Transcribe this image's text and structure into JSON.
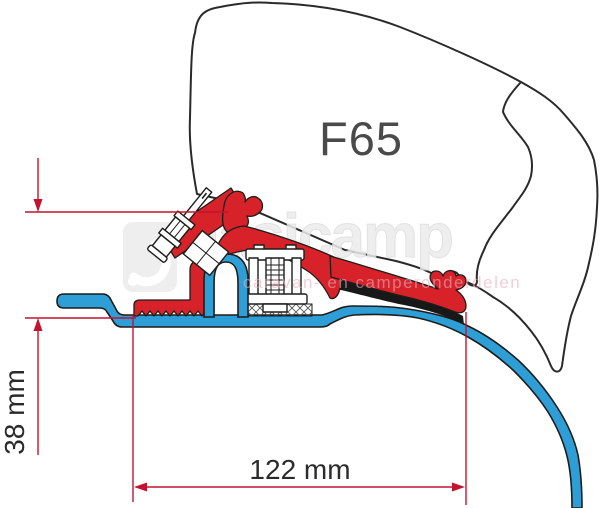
{
  "figure": {
    "product_label": "F65",
    "dimension_vertical": "38 mm",
    "dimension_horizontal": "122 mm"
  },
  "watermark": {
    "brand": "dasicamp",
    "tagline": "caravan- en camperonderdelen"
  },
  "colors": {
    "bracket_red": "#d7222a",
    "profile_blue": "#2e9fd6",
    "dimension_red": "#c41230",
    "outline_black": "#1d1d1b",
    "seal_black": "#181818",
    "label_gray": "#4a4a4a",
    "text_dark": "#2b2b2b",
    "watermark_gray": "#ececec",
    "watermark_edge": "#dedede",
    "watermark_pink": "#e8aebc"
  }
}
